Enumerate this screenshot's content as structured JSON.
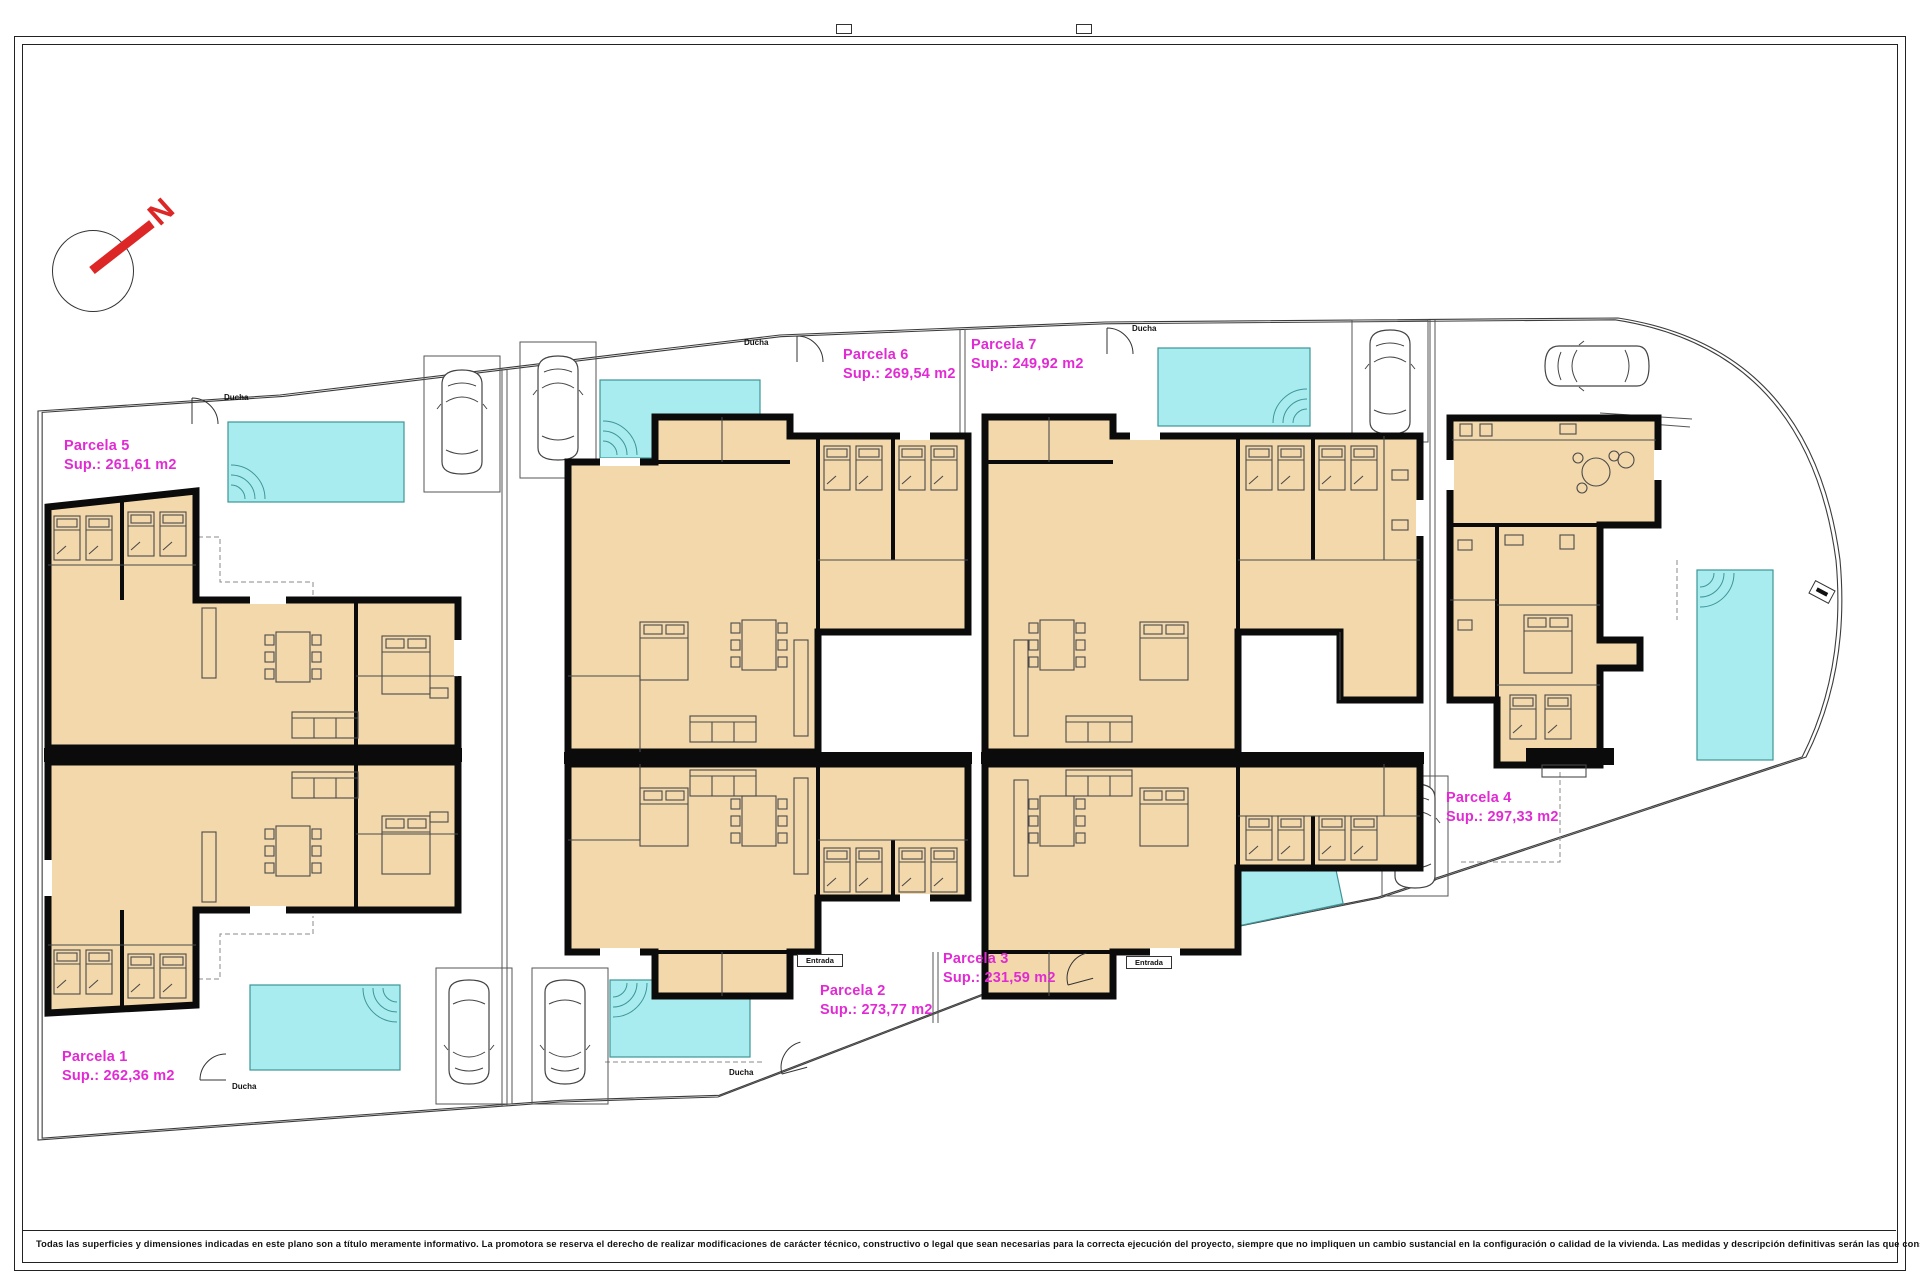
{
  "north": {
    "label": "N"
  },
  "labels": {
    "ducha": "Ducha",
    "entrada": "Entrada"
  },
  "parcels": {
    "p1": {
      "name": "Parcela 1",
      "sup": "Sup.: 262,36 m2"
    },
    "p2": {
      "name": "Parcela 2",
      "sup": "Sup.: 273,77 m2"
    },
    "p3": {
      "name": "Parcela 3",
      "sup": "Sup.: 231,59 m2"
    },
    "p4": {
      "name": "Parcela 4",
      "sup": "Sup.: 297,33 m2"
    },
    "p5": {
      "name": "Parcela 5",
      "sup": "Sup.: 261,61 m2"
    },
    "p6": {
      "name": "Parcela 6",
      "sup": "Sup.: 269,54 m2"
    },
    "p7": {
      "name": "Parcela 7",
      "sup": "Sup.: 249,92 m2"
    }
  },
  "disclaimer": "Todas las superficies y dimensiones indicadas en este plano son a título meramente informativo. La promotora se reserva el derecho de realizar modificaciones de carácter técnico, constructivo o legal que sean necesarias para la correcta ejecución del proyecto, siempre que no impliquen un cambio sustancial en la configuración o calidad de la vivienda. Las medidas y descripción definitivas serán las que consten en la Escritura Pública de Obra Nueva y División Horizontal. Los elementos de mobiliario y decoración son ilustrativos y no están incluidos.",
  "colors": {
    "room_fill": "#f3d8ab",
    "wall_black": "#0b0b0b",
    "pool_fill": "#a9ecef",
    "pool_edge": "#3e9598",
    "label_magenta": "#e22ad4",
    "north_red": "#dd2626"
  }
}
